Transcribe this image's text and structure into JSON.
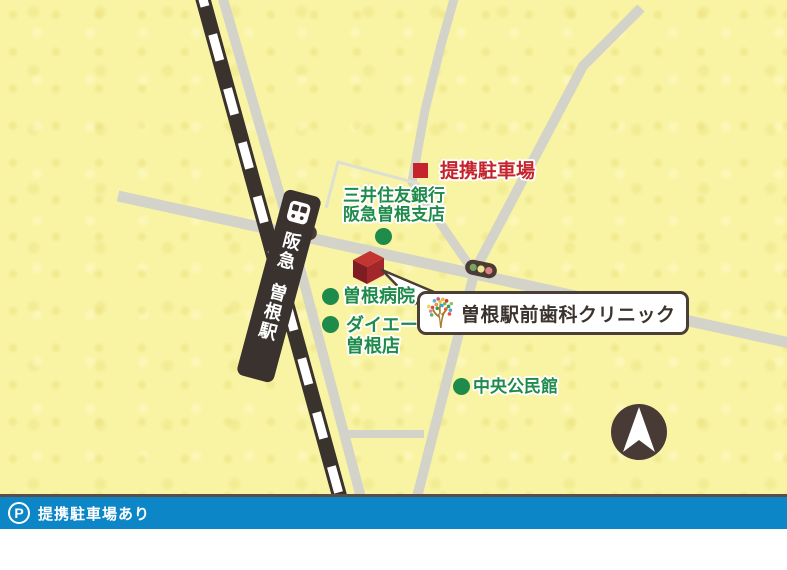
{
  "map": {
    "station": {
      "railway_line": "阪急",
      "station_name": "曽根駅"
    },
    "parking_marker": {
      "label": "提携駐車場"
    },
    "clinic": {
      "label": "曽根駅前歯科クリニック"
    },
    "landmarks": [
      {
        "line1": "三井住友銀行",
        "line2": "阪急曽根支店"
      },
      {
        "line1": "曽根病院"
      },
      {
        "line1": "ダイエー",
        "line2": "曽根店"
      },
      {
        "line1": "中央公民館"
      }
    ],
    "icons": {
      "train": "train-front-icon",
      "traffic_light": "traffic-light-icon",
      "compass": "north-arrow-icon",
      "clinic_logo": "tree-logo-icon"
    }
  },
  "footer": {
    "note": "提携駐車場あり",
    "parking_icon_letter": "P"
  },
  "colors": {
    "map_bg": "#f8f4a4",
    "road_gray": "#d3d3ca",
    "railway_dark": "#3a322c",
    "landmark_green": "#1f8b4b",
    "parking_red": "#c5242c",
    "building_top": "#c23531",
    "building_left": "#7f1d22",
    "building_right": "#a3262b",
    "label_border": "#4a3e36",
    "footer_blue": "#0d86c7",
    "compass_circle": "#483b35"
  }
}
